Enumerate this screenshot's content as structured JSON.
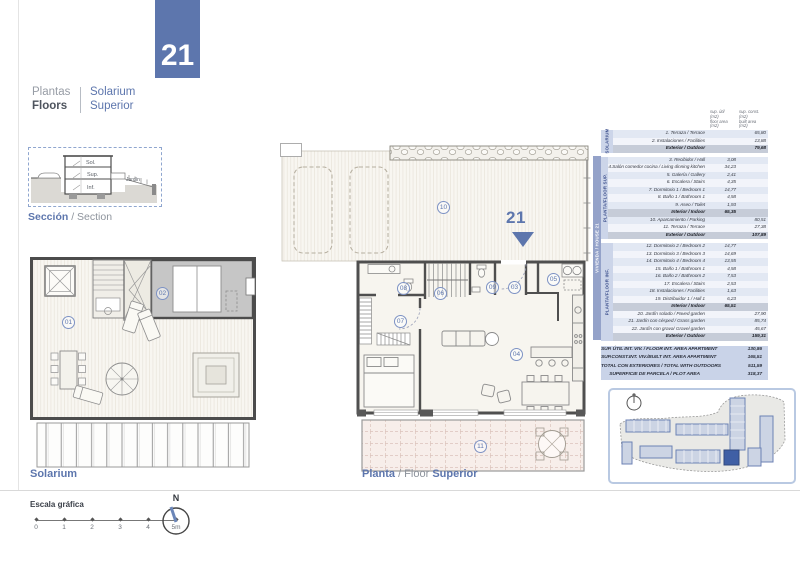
{
  "page": {
    "unit_number": "21"
  },
  "header": {
    "title_es": "Plantas",
    "title_en": "Floors",
    "subtitle_line1": "Solarium",
    "subtitle_line2": "Superior"
  },
  "section_drawing": {
    "caption_es": "Sección",
    "caption_sep": " / Section",
    "labels": {
      "sol": "Sol.",
      "sup": "Sup.",
      "inf": "Inf.",
      "jardin": "Jardín"
    }
  },
  "solarium_plan": {
    "caption": "Solarium"
  },
  "floor_plan": {
    "caption_es": "Planta",
    "caption_sep": " / Floor ",
    "caption_en": "Superior",
    "unit_marker": "21"
  },
  "rooms": {
    "r01": "01",
    "r02": "02",
    "r03": "03",
    "r04": "04",
    "r05": "05",
    "r06": "06",
    "r07": "07",
    "r08": "08",
    "r09": "09",
    "r10": "10",
    "r11": "11"
  },
  "table": {
    "header": {
      "col1": [
        "sup. útil",
        "(m2)",
        "floor area",
        "(m2)"
      ],
      "col2": [
        "sup. const.",
        "(m2)",
        "built area",
        "(m2)"
      ]
    },
    "outer_band_label": "VIVIENDA / HOUSE 21",
    "sections": [
      {
        "band_label": "SOLARIUM",
        "rows": [
          {
            "label": "1. Terraza / Terrace",
            "c1": "",
            "c2": "65,80",
            "total": false
          },
          {
            "label": "2. Instalaciones / Facilities",
            "c1": "",
            "c2": "13,88",
            "total": false
          },
          {
            "label": "Exterior / Outdoor",
            "c1": "",
            "c2": "79,68",
            "total": true
          }
        ]
      },
      {
        "band_label": "PLANTA/FLOOR SUP.",
        "rows": [
          {
            "label": "3. Recibidor / Hall",
            "c1": "3,08",
            "c2": "",
            "total": false
          },
          {
            "label": "4.Salón comedor cocina / Living dinning kitchen",
            "c1": "34,23",
            "c2": "",
            "total": false
          },
          {
            "label": "5. Galería / Gallery",
            "c1": "2,41",
            "c2": "",
            "total": false
          },
          {
            "label": "6. Escalera / Stairs",
            "c1": "4,35",
            "c2": "",
            "total": false
          },
          {
            "label": "7. Dormitorio 1 / Bedroom 1",
            "c1": "14,77",
            "c2": "",
            "total": false
          },
          {
            "label": "8. Baño 1 / Bathroom 1",
            "c1": "4,58",
            "c2": "",
            "total": false
          },
          {
            "label": "9. Aseo / Toilet",
            "c1": "1,93",
            "c2": "",
            "total": false
          },
          {
            "label": "Interior / Indoor",
            "c1": "65,35",
            "c2": "",
            "total": true
          },
          {
            "label": "10. Aparcamiento / Parking",
            "c1": "",
            "c2": "80,51",
            "total": false
          },
          {
            "label": "11. Terraza / Terrace",
            "c1": "",
            "c2": "27,38",
            "total": false
          },
          {
            "label": "Exterior / Outdoor",
            "c1": "",
            "c2": "107,89",
            "total": true
          }
        ]
      },
      {
        "band_label": "PLANTA/FLOOR INF.",
        "rows": [
          {
            "label": "12. Dormitorio 2 / Bedroom 2",
            "c1": "14,77",
            "c2": "",
            "total": false
          },
          {
            "label": "13. Dormitorio 3 / Bedroom 3",
            "c1": "14,69",
            "c2": "",
            "total": false
          },
          {
            "label": "14. Dormitorio 4 / Bedroom 4",
            "c1": "13,55",
            "c2": "",
            "total": false
          },
          {
            "label": "15. Baño 1 / Bathroom 1",
            "c1": "4,58",
            "c2": "",
            "total": false
          },
          {
            "label": "16. Baño 2 / Bathroom 2",
            "c1": "7,53",
            "c2": "",
            "total": false
          },
          {
            "label": "17. Escalera / Stairs",
            "c1": "2,53",
            "c2": "",
            "total": false
          },
          {
            "label": "18. Instalaciones / Facilities",
            "c1": "1,63",
            "c2": "",
            "total": false
          },
          {
            "label": "19. Distribuidor 1 / Hall 1",
            "c1": "6,23",
            "c2": "",
            "total": false
          },
          {
            "label": "Interior / Indoor",
            "c1": "65,51",
            "c2": "",
            "total": true
          },
          {
            "label": "20. Jardín solado / Paved garden",
            "c1": "",
            "c2": "27,90",
            "total": false
          },
          {
            "label": "21. Jardín con césped / Grass garden",
            "c1": "",
            "c2": "85,74",
            "total": false
          },
          {
            "label": "22. Jardín con grava/ Gravel garden",
            "c1": "",
            "c2": "45,67",
            "total": false
          },
          {
            "label": "Exterior / Outdoor",
            "c1": "",
            "c2": "159,31",
            "total": true
          }
        ]
      }
    ],
    "summary": [
      {
        "label": "SUP. ÚTIL INT. VIV. / FLOOR INT. AREA APARTMENT",
        "value": "130,86"
      },
      {
        "label": "SUP.CONST.INT. VIV./BUILT INT. AREA APARTMENT",
        "value": "165,51"
      },
      {
        "label": "TOTAL CON EXTERIORES / TOTAL WITH OUTDOORS",
        "value": "511,59"
      },
      {
        "label": "SUPERFICIE DE PARCELA / PLOT AREA",
        "value": "318,37"
      }
    ]
  },
  "scale": {
    "title": "Escala gráfica",
    "ticks": [
      "0",
      "1",
      "2",
      "3",
      "4",
      "5m"
    ]
  },
  "compass": {
    "label": "N"
  },
  "colors": {
    "accent_blue": "#5d76ad",
    "band_outer": "#94a2c9",
    "band_inner": "#ccd5e9",
    "row_stripe": "#e2e8f3",
    "total_row": "#c6ccd8",
    "terrace_tile": "#f7eeea",
    "highlight_building": "#3f5fa5"
  }
}
